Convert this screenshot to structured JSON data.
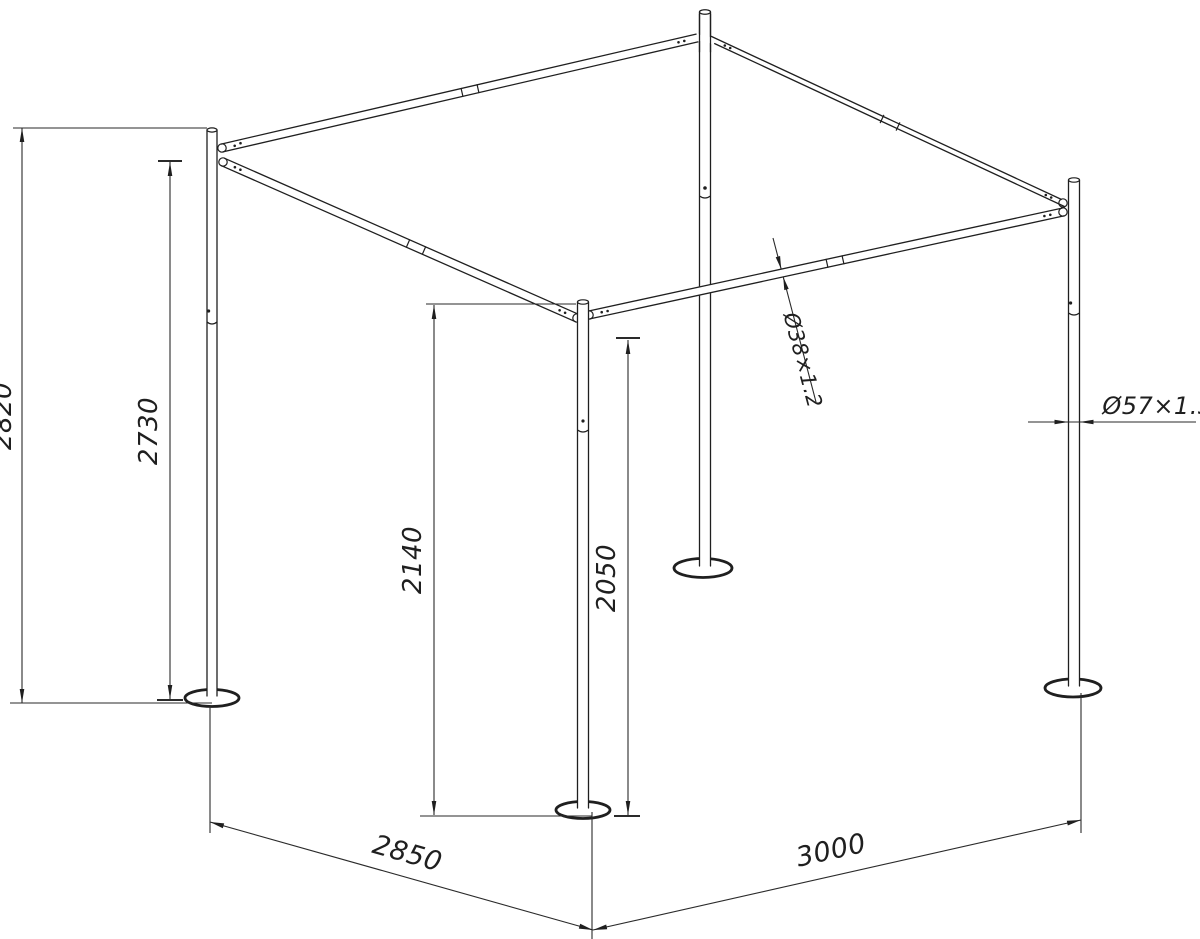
{
  "colors": {
    "ink": "#1f1f1f",
    "paper": "#ffffff"
  },
  "drawing": {
    "dimensions": {
      "overall_height": "2820",
      "rear_post_height": "2730",
      "front_corner_height": "2140",
      "front_post_height": "2050",
      "roof_tube": "Ø38×1.2",
      "post_tube": "Ø57×1.3",
      "base_depth": "2850",
      "base_width": "3000"
    }
  }
}
